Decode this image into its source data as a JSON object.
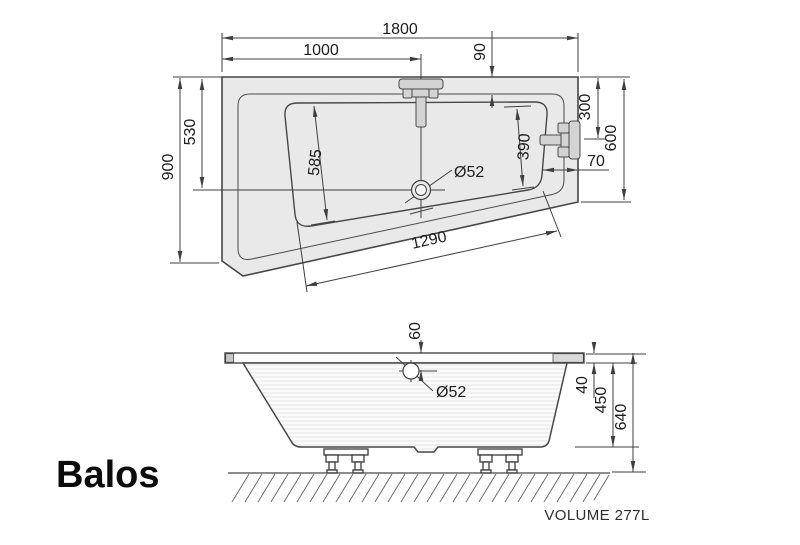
{
  "product": {
    "name": "Balos",
    "volume_label": "VOLUME 277L"
  },
  "top_view": {
    "dims": {
      "overall_length": "1800",
      "faucet_offset": "1000",
      "rim_overhang": "90",
      "left_side_width": "900",
      "top_to_drain": "530",
      "right_fitting_offset": "300",
      "right_side_width": "600",
      "basin_to_edge": "70",
      "basin_left_length": "585",
      "basin_right_length": "390",
      "basin_bottom_length": "1290",
      "drain_diameter": "Ø52"
    }
  },
  "side_view": {
    "dims": {
      "overflow_offset": "60",
      "drain_diameter": "Ø52",
      "rim_thickness": "40",
      "tub_depth": "450",
      "total_height": "640"
    }
  },
  "colors": {
    "tub_fill": "#e9e9e9",
    "line": "#474747",
    "text": "#1d1d1d"
  }
}
